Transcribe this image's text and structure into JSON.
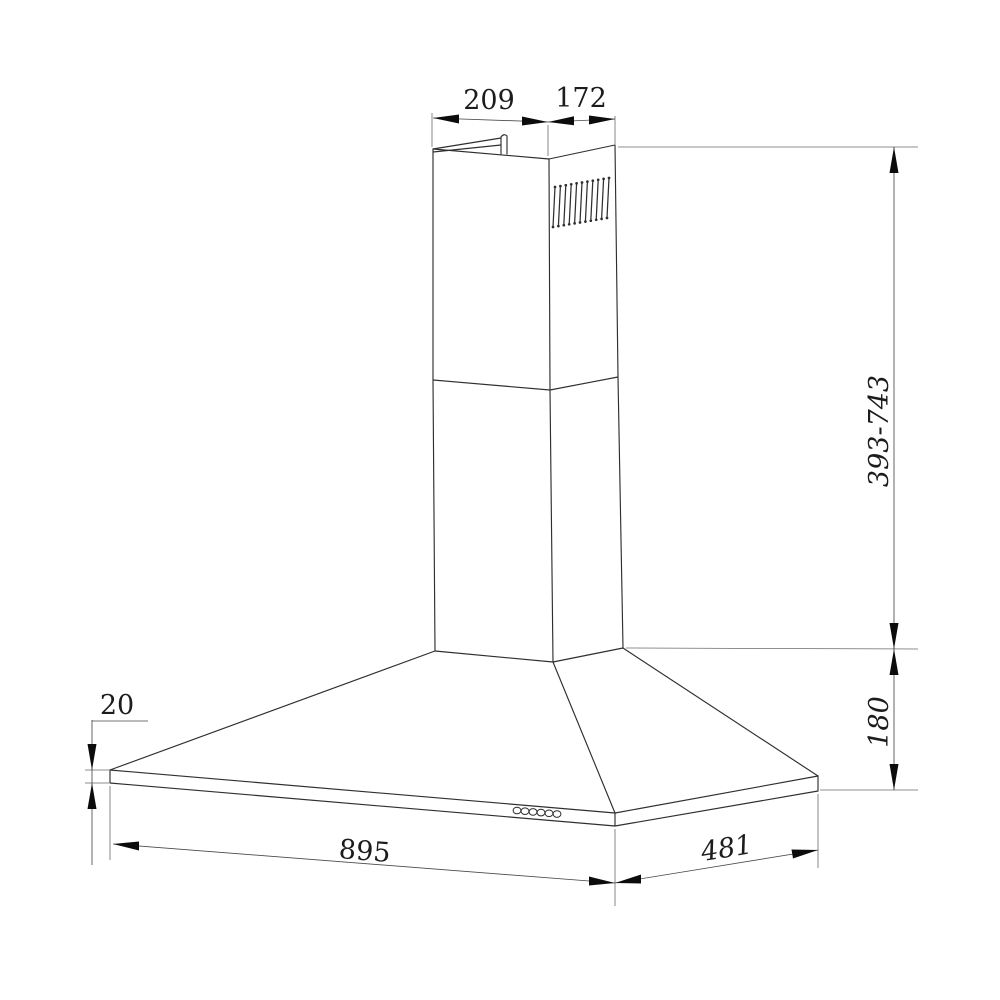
{
  "diagram": {
    "colors": {
      "line": "#2f2f2f",
      "dimension_line": "#4a4a4a",
      "extension_line": "#6a6a6a",
      "arrow": "#0c0c0c",
      "text": "#1c1c1c",
      "background": "#ffffff"
    },
    "dimensions": {
      "chimney_top_width": "209",
      "chimney_top_depth": "172",
      "chimney_height_range": "393-743",
      "canopy_height": "180",
      "rim_height": "20",
      "hood_width": "895",
      "hood_depth": "481"
    }
  }
}
